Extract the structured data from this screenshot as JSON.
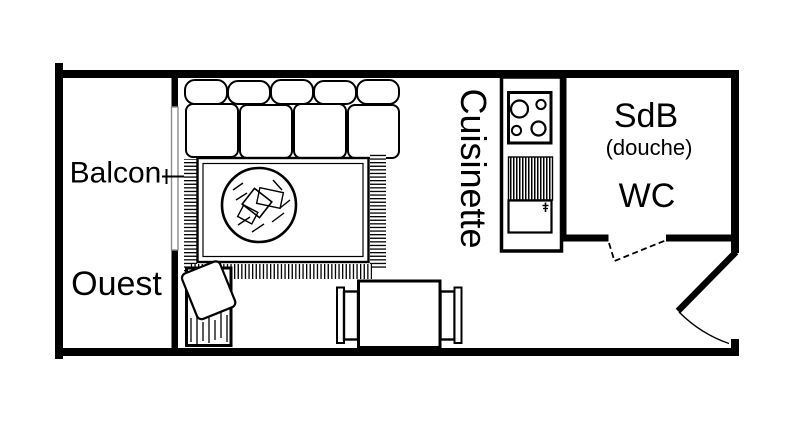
{
  "plan": {
    "type": "studio-floorplan",
    "labels": {
      "balcony": "Balcon",
      "orientation": "Ouest",
      "kitchenette": "Cuisinette",
      "bathroom": "SdB",
      "bathroom_note": "(douche)",
      "toilet": "WC"
    },
    "colors": {
      "line": "#000000",
      "background": "#ffffff",
      "window_frame": "#8c8c8c"
    }
  }
}
